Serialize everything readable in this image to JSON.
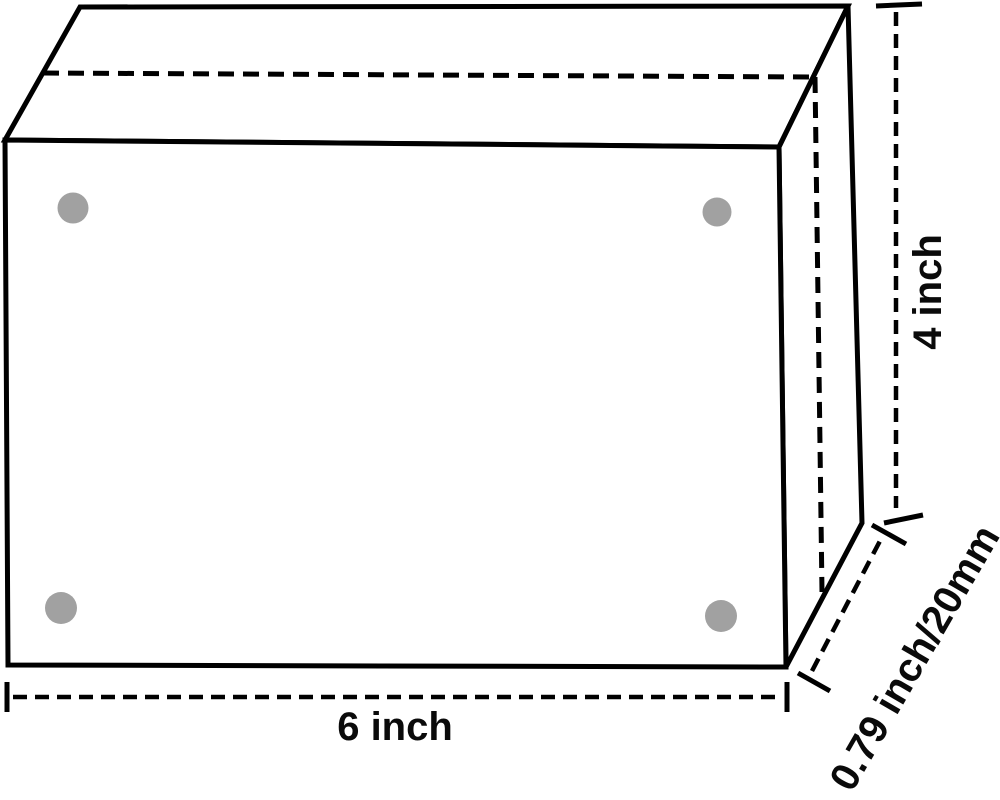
{
  "diagram": {
    "kind": "box-dimension-drawing",
    "dimensions": {
      "width_label": "6 inch",
      "height_label": "4 inch",
      "depth_label": "0.79 inch/20mm"
    },
    "dot_count": 4,
    "colors": {
      "line": "#000000",
      "dot": "#a1a1a1",
      "background": "#ffffff"
    }
  }
}
